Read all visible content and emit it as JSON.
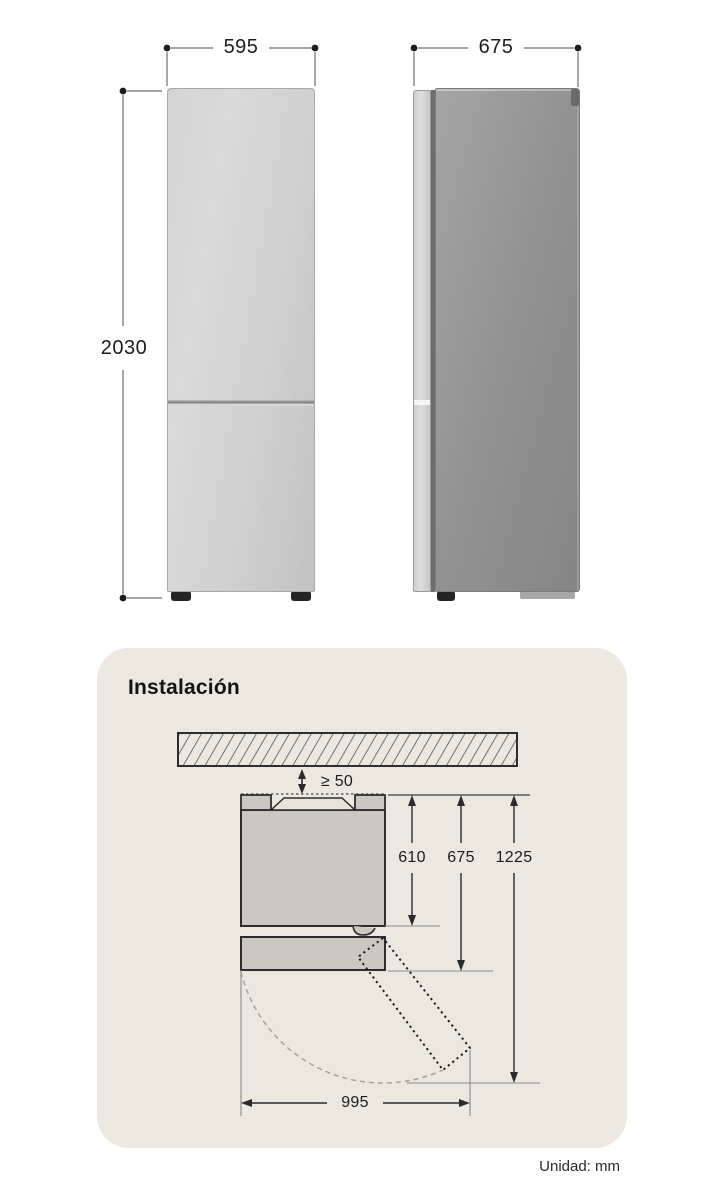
{
  "dimension_figure": {
    "front_view": {
      "width_label": "595",
      "height_label": "2030"
    },
    "side_view": {
      "depth_label": "675"
    }
  },
  "installation": {
    "title": "Instalación",
    "clearance_label": "≥ 50",
    "body_depth_label": "610",
    "door_closed_depth_label": "675",
    "door_open_depth_label": "1225",
    "door_swing_width_label": "995"
  },
  "footer": {
    "unit_label": "Unidad: mm"
  },
  "colors": {
    "panel_bg": "#EDE8DF",
    "fridge_front": "#CFCFCF",
    "fridge_side": "#929292",
    "diagram_fill": "#CBC8C1",
    "outline": "#2D2D2D",
    "dim_line": "#6F6F6F"
  }
}
